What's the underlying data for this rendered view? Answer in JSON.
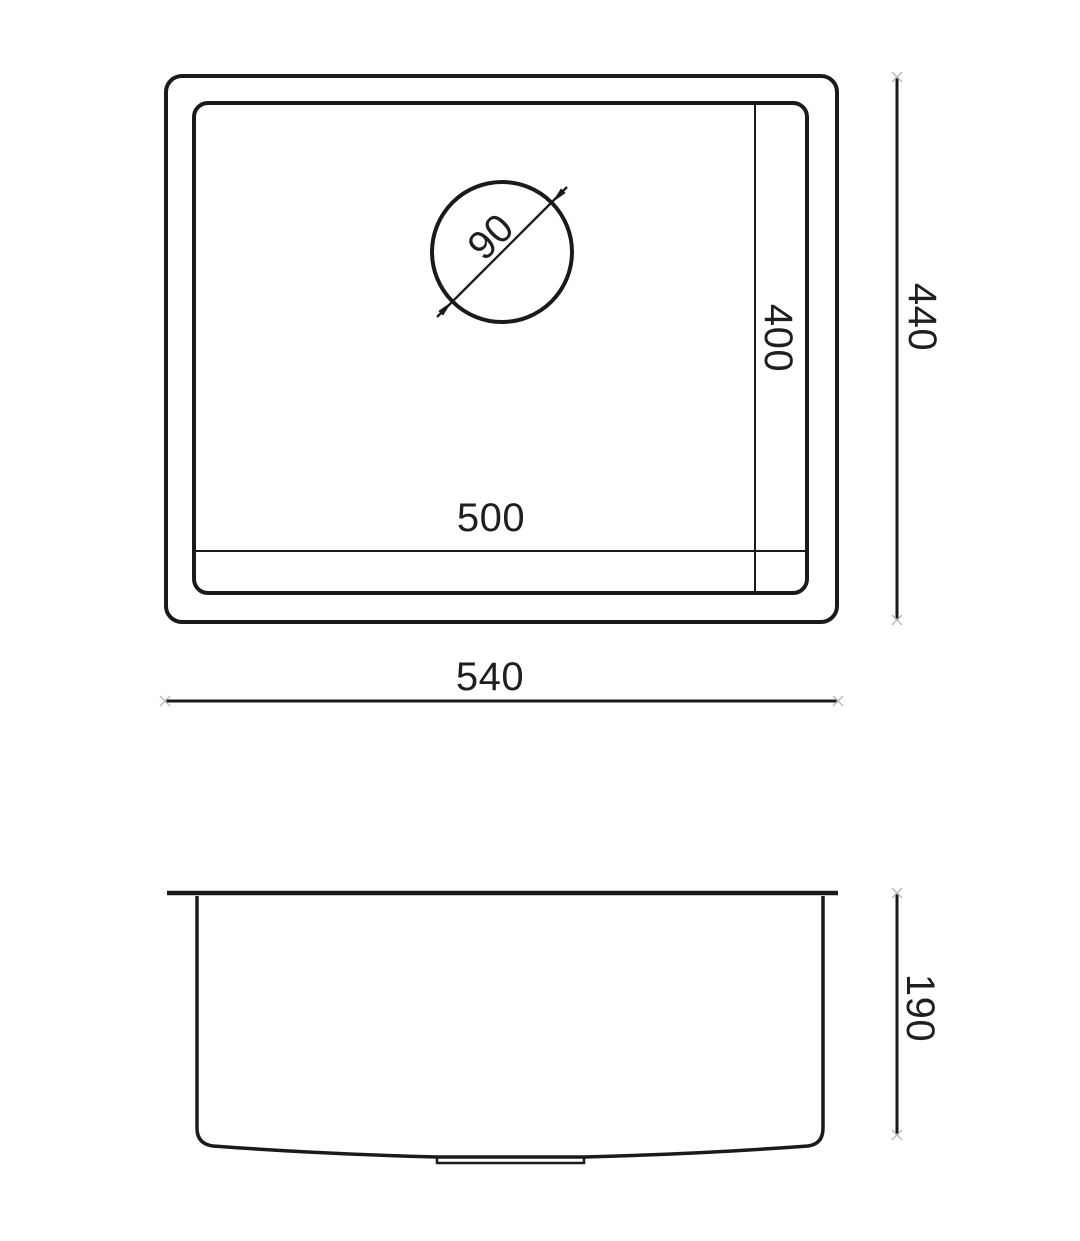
{
  "labels": {
    "drain_diameter": "90",
    "bowl_width": "500",
    "bowl_depth": "400",
    "overall_width": "540",
    "overall_depth": "440",
    "overall_height": "190"
  },
  "colors": {
    "line": "#1a1a1a",
    "background": "#ffffff",
    "tick": "#b9b9b9"
  }
}
